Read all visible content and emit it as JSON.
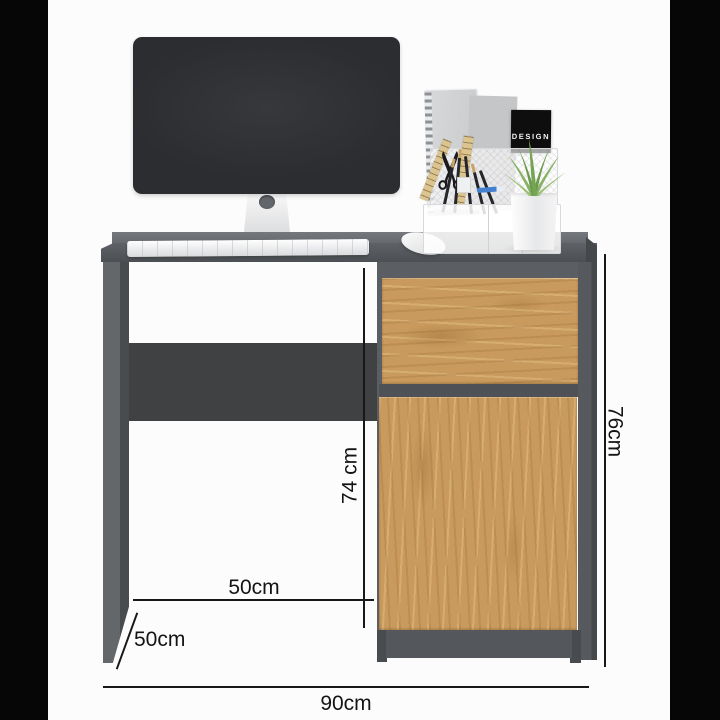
{
  "meta": {
    "kind": "furniture-product-dimension-image",
    "subject": "graphite desk with oak drawer and cabinet door, monitor and desk accessories"
  },
  "frame": {
    "background": "#fcfcfc",
    "side_bar_color": "#060606"
  },
  "annotations": {
    "line_color": "#181818",
    "width": {
      "label": "90cm"
    },
    "height": {
      "label": "76cm"
    },
    "inner_height": {
      "label": "74 cm"
    },
    "inner_width": {
      "label": "50cm"
    },
    "depth": {
      "label": "50cm"
    }
  },
  "desk": {
    "frame_color": "#55585c",
    "top_surface_color": "#6c6f73",
    "back_panel_color": "#3f4143",
    "wood_color": "#c89a5d"
  },
  "decor": {
    "design_card": {
      "label": "DESIGN",
      "bg": "#0e0e0e",
      "text_color": "#f4f4f4"
    },
    "monitor_color": "#2f3033",
    "device_color": "#f3f4f6",
    "pen_color": "#4381cf",
    "plant_colors": [
      "#6a9a4b",
      "#76a354",
      "#88b164",
      "#9fc07a"
    ],
    "icons": {
      "scissors_glyph": "✂"
    }
  }
}
